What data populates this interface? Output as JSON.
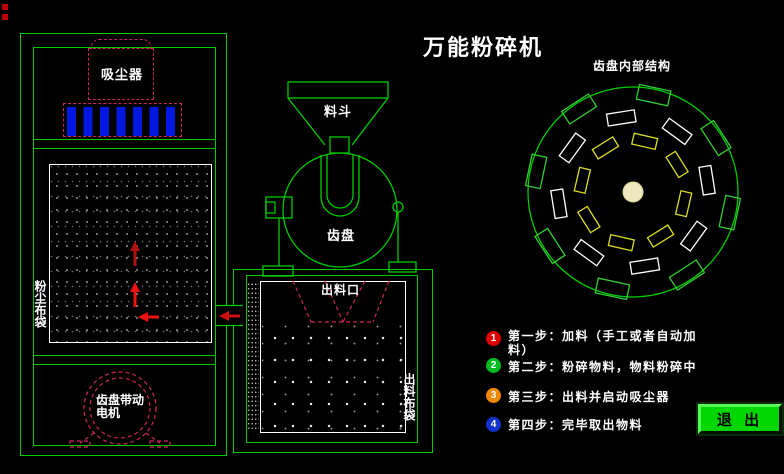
{
  "title": "万能粉碎机",
  "machine": {
    "vacuum_label": "吸尘器",
    "dust_bag_label": "粉尘布袋",
    "motor_label": "齿盘带动电机",
    "hopper_label": "料斗",
    "gear_disk_label": "齿盘",
    "outlet_label": "出料口",
    "outlet_bag_label": "出料布袋"
  },
  "wheel": {
    "caption": "齿盘内部结构"
  },
  "steps": [
    {
      "num": "1",
      "color": "#dd0000",
      "text": "第一步：加料（手工或者自动加料）"
    },
    {
      "num": "2",
      "color": "#00bb22",
      "text": "第二步：粉碎物料，物料粉碎中"
    },
    {
      "num": "3",
      "color": "#ee8800",
      "text": "第三步：出料并启动吸尘器"
    },
    {
      "num": "4",
      "color": "#1133cc",
      "text": "第四步：完毕取出物料"
    }
  ],
  "exit_button": {
    "label": "退 出"
  },
  "colors": {
    "line_green": "#00cc00",
    "dashed_pink": "#cc2266",
    "bar_blue": "#0018e0",
    "arrow_red": "#ee1111",
    "marker_red": "#c00000",
    "tooth_green": "#33cc33",
    "tooth_white": "#ffffff",
    "tooth_yellow": "#dddd22",
    "hub_fill": "#eee8c2"
  }
}
